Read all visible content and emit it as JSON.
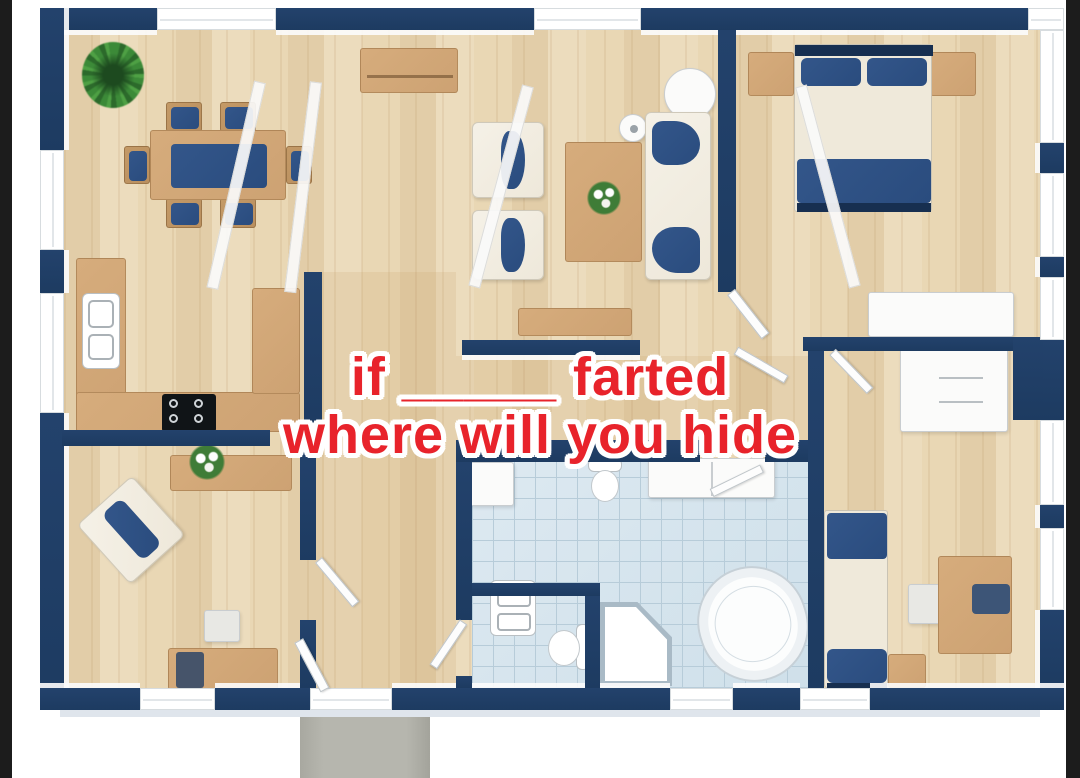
{
  "meme": {
    "line1": "if _____ farted",
    "line2": "where will you hide"
  },
  "colors": {
    "letterbox": "#1c1c1c",
    "wall": "#1d3b61",
    "floor_a": "#ecdcbd",
    "floor_b": "#e2cda8",
    "wood": "#cda273",
    "wood_dark": "#b98f5f",
    "navy_fabric": "#2a4c7e",
    "navy_deep": "#172f50",
    "cream": "#eee8da",
    "tile": "#cfe0ea",
    "tile_line": "#b7ccd9",
    "porch": "#b6b6ae",
    "text_red": "#e8232b",
    "outline_white": "#ffffff"
  },
  "scene": {
    "type": "3d-floor-plan",
    "rooms": [
      "dining-room",
      "living-room",
      "master-bedroom",
      "kitchen",
      "office",
      "hallway",
      "bathroom",
      "wc-nook",
      "second-bedroom",
      "closet",
      "entry-porch"
    ],
    "furniture": [
      "potted-plant",
      "dining-table",
      "dining-chair",
      "tv-sideboard",
      "armchair",
      "coffee-table",
      "flower-bouquet",
      "sofa",
      "round-side-table",
      "floor-lamp",
      "console-table",
      "double-bed",
      "nightstand",
      "dresser",
      "wardrobe",
      "kitchen-counter",
      "kitchen-sink",
      "stove",
      "office-armchair",
      "office-desk",
      "desk-chair",
      "computer",
      "single-bed",
      "desk",
      "laptop",
      "bathtub",
      "corner-shower",
      "toilet",
      "vanity",
      "bathroom-cabinet",
      "front-door"
    ]
  }
}
